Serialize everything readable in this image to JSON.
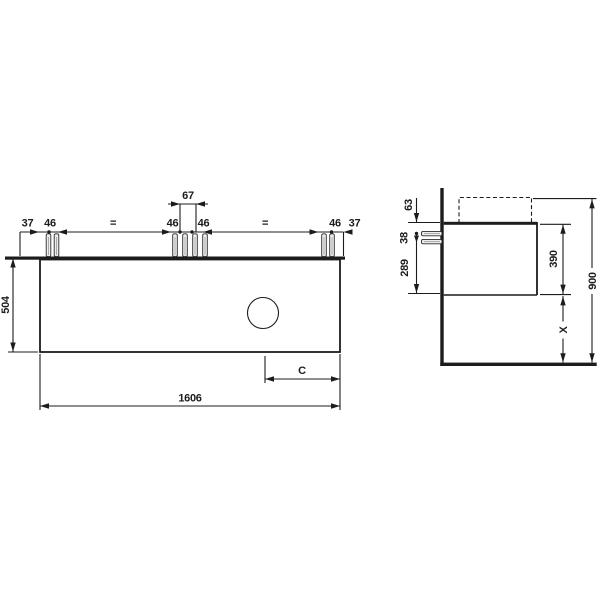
{
  "front_view": {
    "dims": {
      "edge_left": "37",
      "screw_pair_left": "46",
      "equal_left": "=",
      "screw_pair_center_left": "46",
      "center_group_span": "67",
      "screw_pair_center_right": "46",
      "equal_right": "=",
      "screw_pair_right": "46",
      "edge_right": "37",
      "cabinet_height": "504",
      "cabinet_width": "1606",
      "drain_to_edge": "C"
    }
  },
  "side_view": {
    "dims": {
      "top_offset": "63",
      "screw_spacing": "38",
      "screw_to_bottom": "289",
      "cabinet_depth_height": "390",
      "floor_clearance": "X",
      "total_height": "900"
    }
  },
  "colors": {
    "line": "#1c1c1c",
    "background": "#ffffff",
    "screw_fill": "#ededed"
  }
}
